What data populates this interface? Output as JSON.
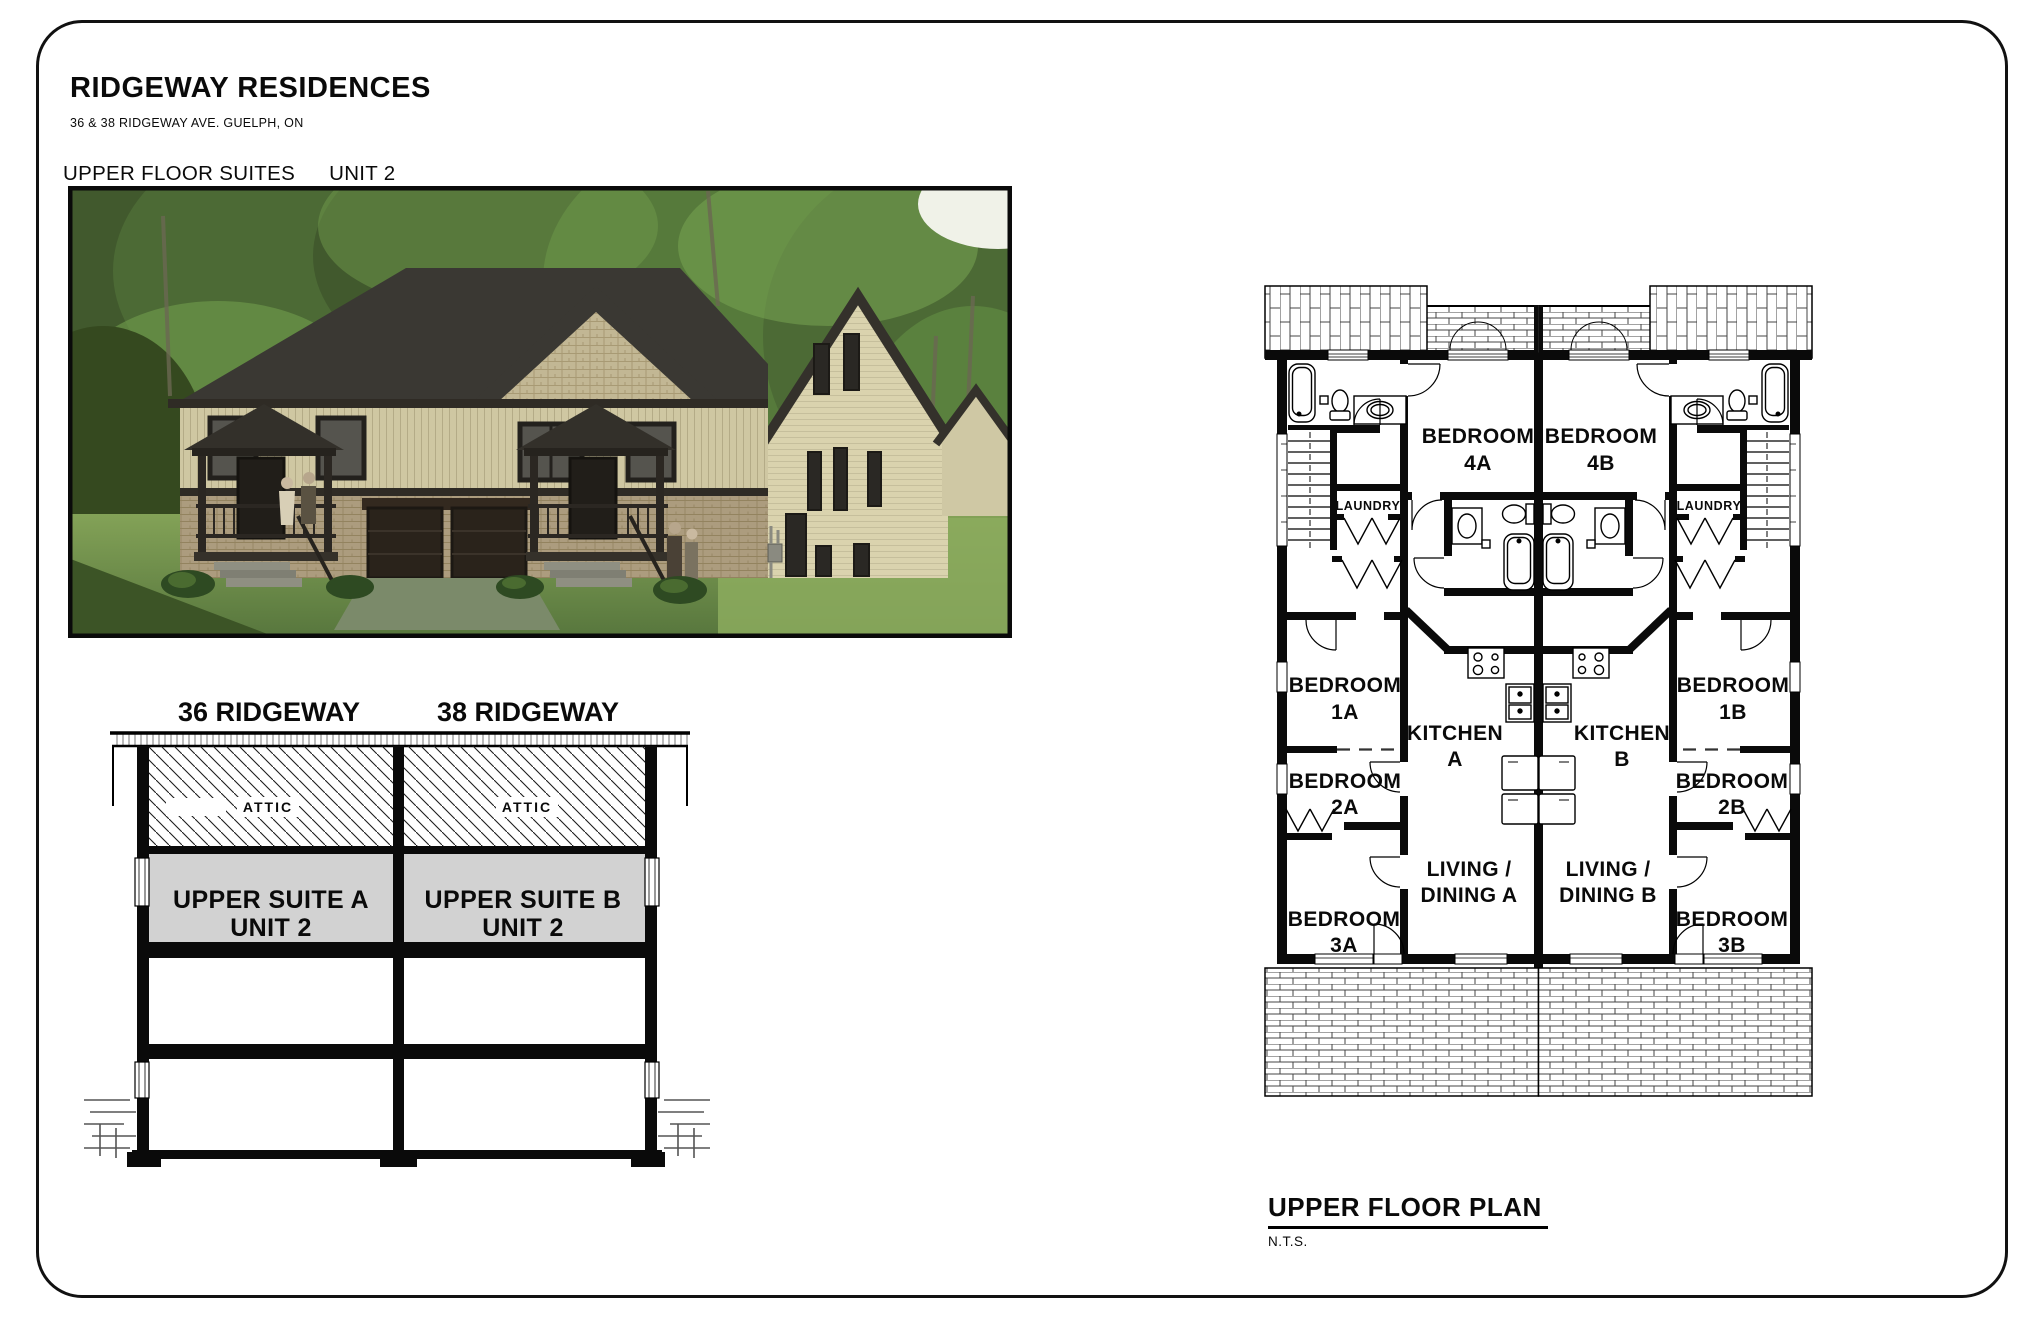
{
  "header": {
    "title": "RIDGEWAY RESIDENCES",
    "subtitle": "36 & 38 RIDGEWAY AVE. GUELPH, ON",
    "sheet_label": "UPPER FLOOR SUITES",
    "unit_label": "UNIT 2"
  },
  "section": {
    "house_a_header": "36 RIDGEWAY",
    "house_b_header": "38 RIDGEWAY",
    "attic_a": "ATTIC",
    "attic_b": "ATTIC",
    "suite_a_line1": "UPPER SUITE A",
    "suite_a_line2": "UNIT 2",
    "suite_b_line1": "UPPER SUITE B",
    "suite_b_line2": "UNIT 2"
  },
  "floor_plan": {
    "title": "UPPER FLOOR PLAN",
    "scale_note": "N.T.S.",
    "rooms": {
      "bedroom4a": [
        "BEDROOM",
        "4A"
      ],
      "bedroom4b": [
        "BEDROOM",
        "4B"
      ],
      "laundry_a": "LAUNDRY",
      "laundry_b": "LAUNDRY",
      "bedroom1a": [
        "BEDROOM",
        "1A"
      ],
      "bedroom1b": [
        "BEDROOM",
        "1B"
      ],
      "kitchen_a": [
        "KITCHEN",
        "A"
      ],
      "kitchen_b": [
        "KITCHEN",
        "B"
      ],
      "bedroom2a": [
        "BEDROOM",
        "2A"
      ],
      "bedroom2b": [
        "BEDROOM",
        "2B"
      ],
      "living_a": [
        "LIVING /",
        "DINING A"
      ],
      "living_b": [
        "LIVING /",
        "DINING B"
      ],
      "bedroom3a": [
        "BEDROOM",
        "3A"
      ],
      "bedroom3b": [
        "BEDROOM",
        "3B"
      ]
    }
  },
  "colors": {
    "roof": "#3a3833",
    "trim": "#2c2823",
    "siding_front": "#cfc7a2",
    "siding_side": "#dad3ae",
    "gable_shake": "#c2b794",
    "brick": "#ac9c7e",
    "garage_door": "#2a231b",
    "grass": "#6d8c49",
    "foliage_dark": "#3f5a2e",
    "foliage_light": "#6f9a4b",
    "suite_fill": "#d2d2d2"
  }
}
